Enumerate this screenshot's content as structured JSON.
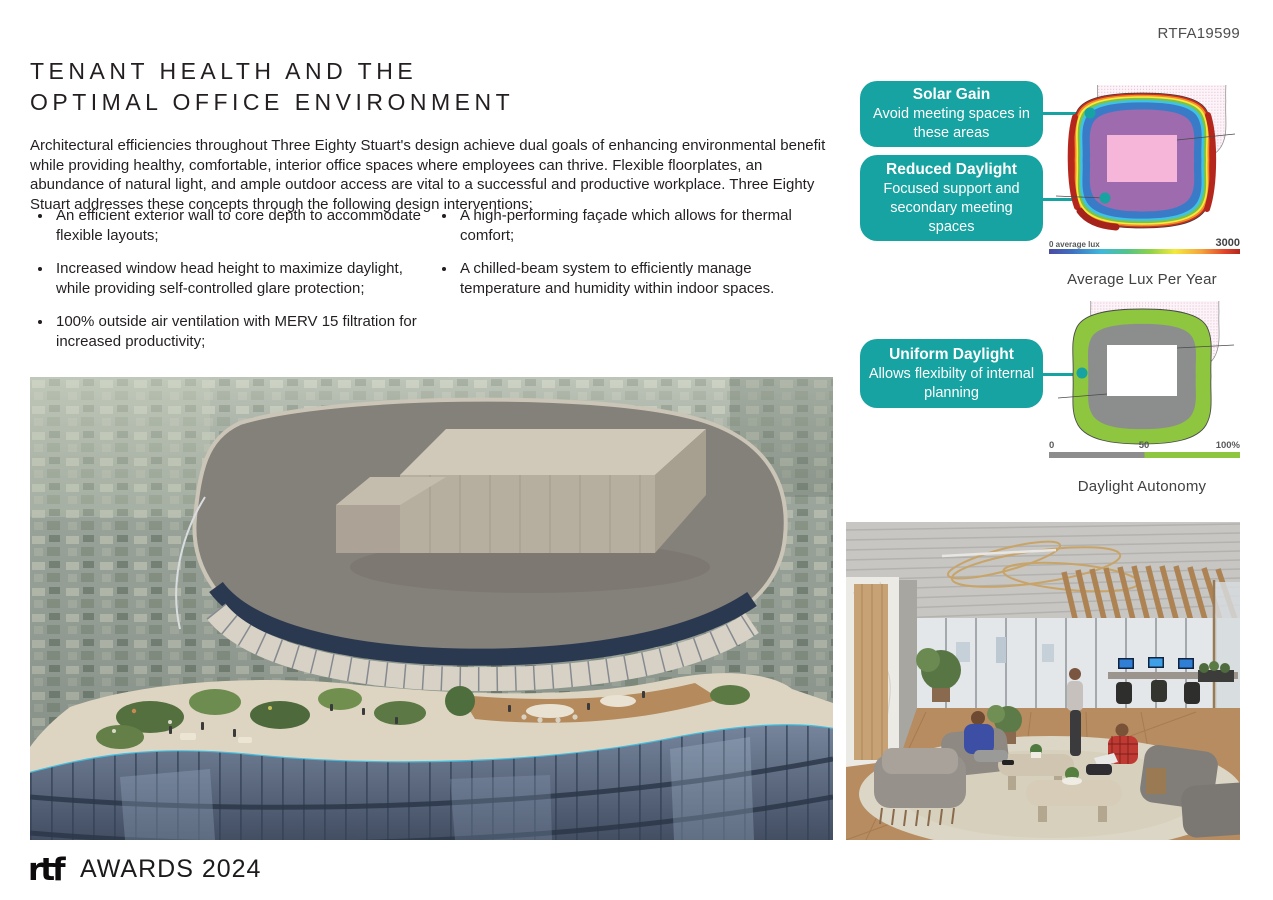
{
  "page": {
    "ref_code": "RTFA19599"
  },
  "header": {
    "title_line1": "TENANT HEALTH AND THE",
    "title_line2": "OPTIMAL OFFICE ENVIRONMENT",
    "intro": "Architectural efficiencies throughout Three Eighty Stuart's design achieve dual goals of enhancing environmental benefit while providing healthy, comfortable, interior office spaces where employees can thrive. Flexible floorplates, an abundance of natural light, and ample outdoor access are vital to a successful and productive workplace. Three Eighty Stuart addresses these concepts through the following design interventions:"
  },
  "bullets": {
    "left": [
      "An efficient exterior wall to core depth to accommodate flexible layouts;",
      "Increased window head height to maximize daylight, while providing self-controlled glare protection;",
      "100% outside air ventilation with MERV 15 filtration for increased productivity;"
    ],
    "right": [
      "A high-performing façade which allows for thermal comfort;",
      "A chilled-beam system to efficiently manage temperature and humidity within indoor spaces."
    ]
  },
  "callouts": {
    "solar_gain": {
      "title": "Solar Gain",
      "body": "Avoid meeting spaces in these areas"
    },
    "reduced_daylight": {
      "title": "Reduced Daylight",
      "body": "Focused support and secondary meeting spaces"
    },
    "uniform_daylight": {
      "title": "Uniform Daylight",
      "body": "Allows flexibilty of internal planning"
    }
  },
  "diagrams": {
    "lux": {
      "caption": "Average Lux Per Year",
      "scale_min_label": "0 average lux",
      "scale_max_label": "3000",
      "scale_min": 0,
      "scale_max": 3000
    },
    "daylight_autonomy": {
      "caption": "Daylight Autonomy",
      "tick_0": "0",
      "tick_50": "50",
      "tick_100": "100%",
      "threshold_percent": 50
    }
  },
  "footer": {
    "brand": "rtf",
    "text": "AWARDS 2024"
  },
  "colors": {
    "accent_teal": "#16a3a1",
    "heat_core_purple": "#9d6bae",
    "heat_center_pink": "#f6b6d9",
    "heat_edge_red": "#c5301f",
    "da_green": "#8ec63f",
    "da_gray": "#8d8d8d"
  }
}
